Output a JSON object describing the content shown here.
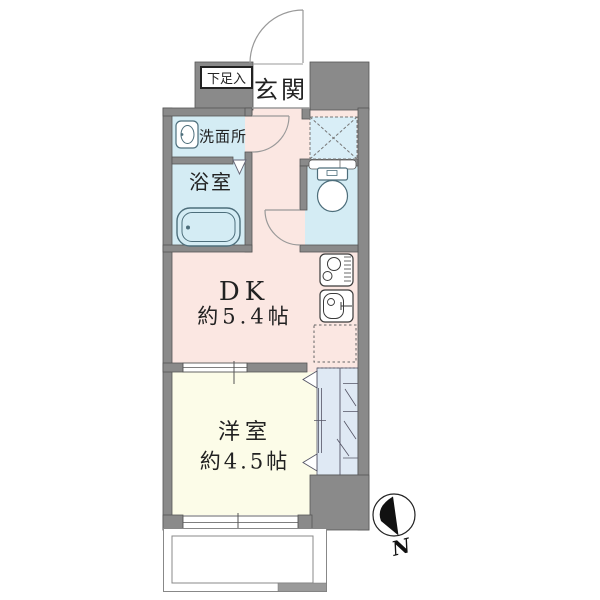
{
  "plan": {
    "rooms": {
      "entrance": {
        "label": "玄関"
      },
      "shoe_storage": {
        "label": "下足入"
      },
      "washroom": {
        "label": "洗面所"
      },
      "bathroom": {
        "label": "浴室"
      },
      "dining_kitchen": {
        "label": "DK",
        "size": "約5.4帖"
      },
      "western_room": {
        "label": "洋室",
        "size": "約4.5帖"
      }
    },
    "compass": {
      "north_label": "N"
    },
    "icons": {
      "bathtub": "bathtub-icon",
      "washbasin": "washbasin-icon",
      "toilet": "toilet-icon",
      "stove": "stove-icon",
      "kitchen_sink": "kitchen-sink-icon",
      "refrigerator_space": "dashed-square",
      "storage_cross_square": "dashed-x-square",
      "closet": "closet-hanger-pipe",
      "north_arrow": "north-arrow-icon"
    },
    "colors": {
      "wall": "#8a8a8a",
      "wall_edge": "#555555",
      "dk_floor": "#fbe7e2",
      "western_floor": "#fcfce8",
      "wet_floor": "#d4ecf4",
      "closet_floor": "#dfe9f4",
      "square_fill": "#d9eef7",
      "fixture_line": "#4d6e7b",
      "door_arc": "#999999"
    }
  }
}
